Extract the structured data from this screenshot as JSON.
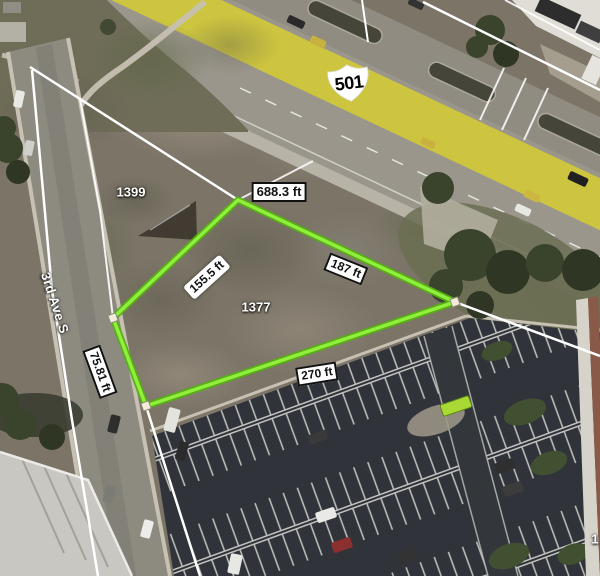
{
  "map": {
    "view": "aerial parcel map",
    "highway": {
      "shield": "501"
    },
    "street": {
      "name": "3rd Ave S"
    },
    "parcels": {
      "left": {
        "number": "1399"
      },
      "highlighted": {
        "number": "1377"
      },
      "edge_partial": {
        "number": "1"
      }
    },
    "measurements": {
      "boundary": "688.3 ft",
      "side_upper_left": "155.5 ft",
      "side_upper_right": "187 ft",
      "side_bottom": "270 ft",
      "side_road": "75.81 ft"
    },
    "colors": {
      "parcel_outline_core": "#8FEF3C",
      "parcel_outline_edge": "#55B011",
      "boundary_line": "#FFFFFF",
      "highway_paint": "#CDC53F",
      "label_bg": "#FFFFFF",
      "label_border": "#111111",
      "label_text": "#111111",
      "map_text": "#FFFFFF"
    }
  }
}
